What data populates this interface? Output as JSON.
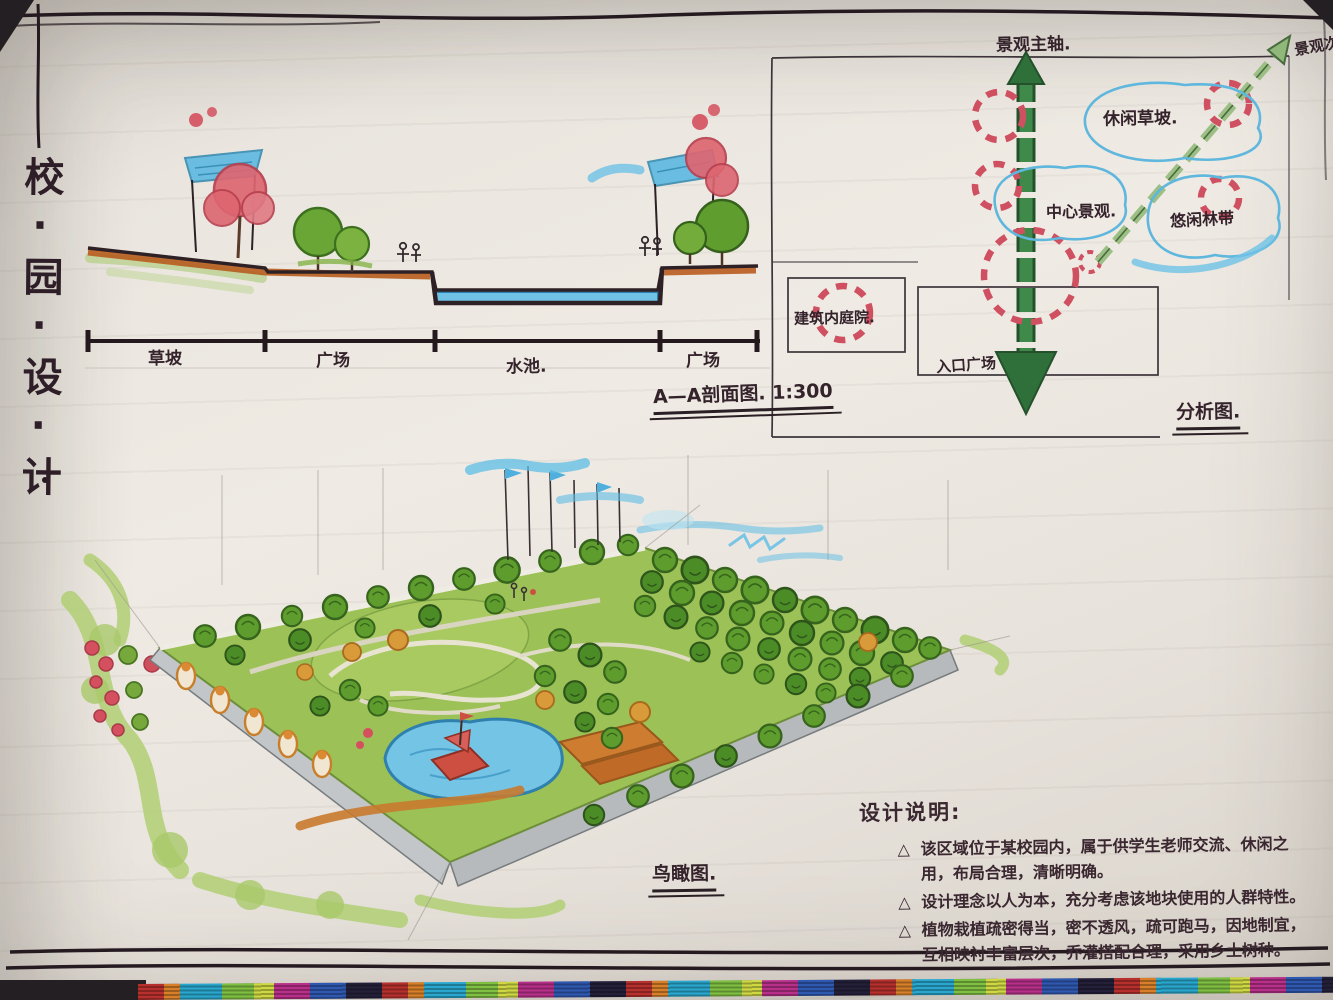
{
  "board": {
    "vertical_title": "校·园·设·计",
    "bullet_marker": "△"
  },
  "section_view": {
    "title": "A—A剖面图.",
    "scale": "1:300",
    "labels": {
      "slope": "草坡",
      "plaza_left": "广场",
      "pool": "水池.",
      "plaza_right": "广场"
    }
  },
  "analysis": {
    "title": "分析图.",
    "main_axis": "景观主轴.",
    "secondary_axis": "景观次轴",
    "zone_leisure_slope": "休闲草坡.",
    "zone_central": "中心景观.",
    "zone_forest_belt": "悠闲林带",
    "zone_courtyard": "建筑内庭院.",
    "zone_entrance": "入口广场"
  },
  "aerial": {
    "title": "鸟瞰图."
  },
  "notes": {
    "heading": "设计说明:",
    "items": [
      "该区域位于某校园内，属于供学生老师交流、休闲之用，布局合理，清晰明确。",
      "设计理念以人为本，充分考虑该地块使用的人群特性。",
      "植物栽植疏密得当，密不透风，疏可跑马，因地制宜，互相映衬丰富层次，乔灌搭配合理，采用乡土树种。"
    ]
  },
  "colors": {
    "paper": "#ece8e1",
    "ink": "#35232c",
    "marker_green": "#5d9c2d",
    "axis_green": "#2f6f3a",
    "light_green": "#b2cf74",
    "sky_blue": "#59bbe4",
    "water_blue": "#72c3e6",
    "orange": "#c06a28",
    "red": "#d4505e",
    "wall_gray": "#b9bdbf"
  }
}
